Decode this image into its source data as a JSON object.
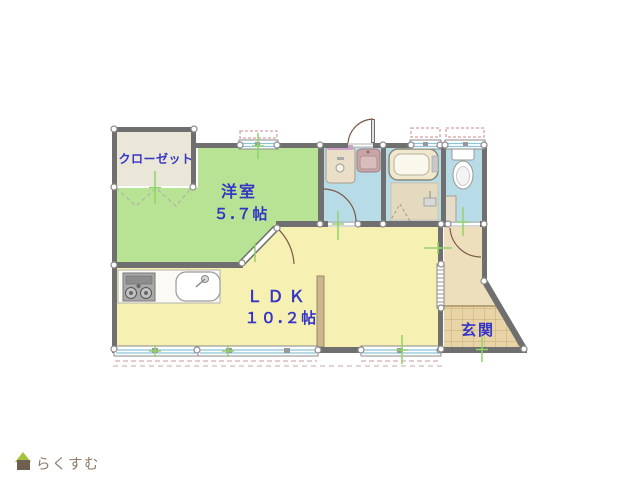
{
  "rooms": {
    "closet": {
      "label": "クローゼット"
    },
    "western": {
      "label": "洋室",
      "size": "５.７帖"
    },
    "ldk": {
      "label": "ＬＤＫ",
      "size": "１０.２帖"
    },
    "entrance": {
      "label": "玄関"
    }
  },
  "logo": {
    "text": "らくすむ"
  },
  "colors": {
    "wall": "#6f6f6f",
    "western_room": "#b9e394",
    "ldk_room": "#f6f0b2",
    "wet_room": "#b7dce8",
    "closet_room": "#eae6d8",
    "hallway": "#eedfbc",
    "entrance_tile": "#e8d4a6",
    "tile_grid": "#c9ab72",
    "label_text": "#3535c5",
    "logo_text": "#8d7b6b",
    "logo_roof": "#a6c23d",
    "logo_body": "#6e5f50",
    "marker_green": "#8fd468",
    "window_dash_red": "#c98888",
    "door_arc": "#7a5a46",
    "window_glass": "#8ec4d8"
  }
}
